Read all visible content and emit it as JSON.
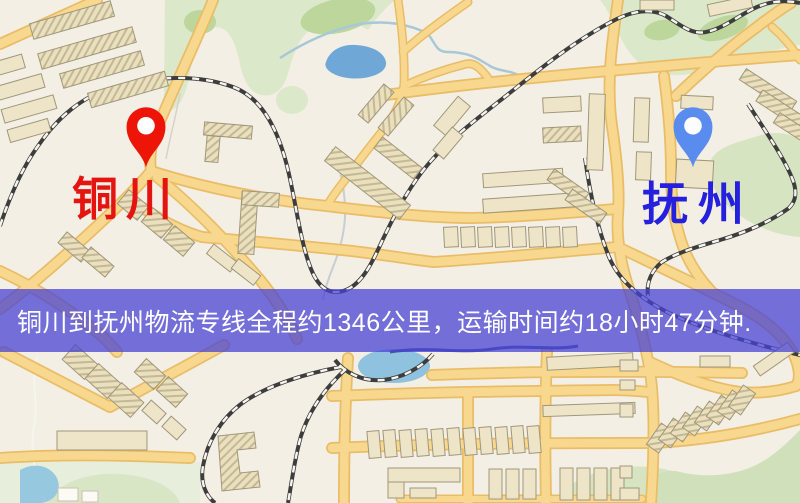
{
  "map": {
    "origin": {
      "name": "铜川",
      "pin_color": "#ec1508",
      "label_color": "#e41410"
    },
    "destination": {
      "name": "抚州",
      "pin_color": "#5a8cf0",
      "label_color": "#2420dd"
    }
  },
  "banner": {
    "text": "铜川到抚州物流专线全程约1346公里，运输时间约18小时47分钟.",
    "background": "rgba(72,66,212,0.74)",
    "text_color": "#ffffff"
  },
  "route_facts": {
    "from_city": "铜川",
    "to_city": "抚州",
    "distance": "约1346公里",
    "duration": "约18小时47分钟"
  }
}
